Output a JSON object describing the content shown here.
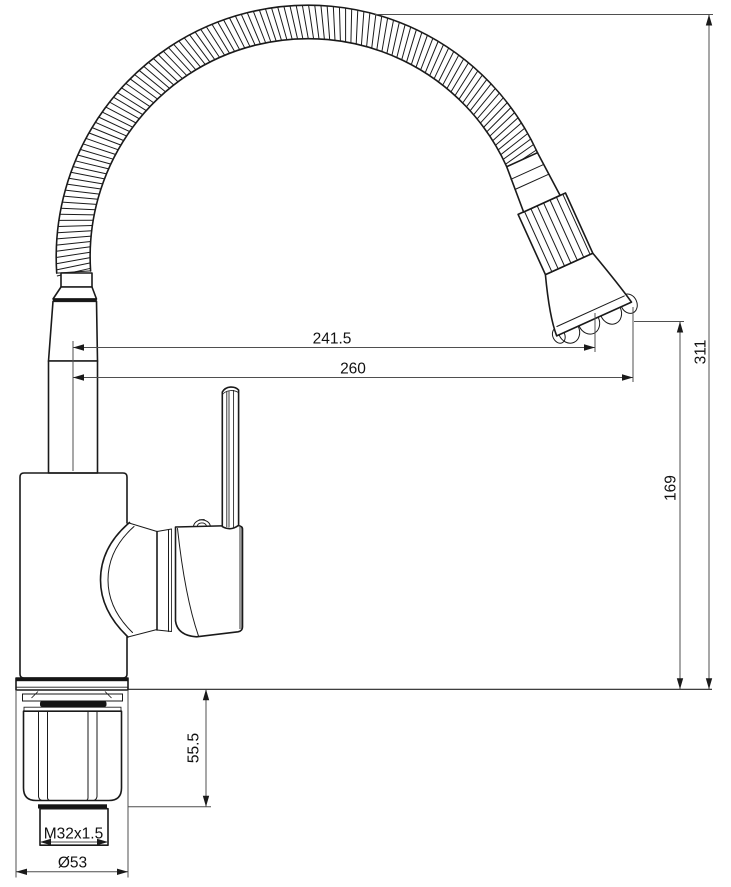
{
  "diagram": {
    "background": "#ffffff",
    "line_color": "#1a1a1a",
    "dimension_color": "#4f4f4f",
    "dimensions": {
      "reach_to_outlet": {
        "label": "241.5"
      },
      "reach_overall": {
        "label": "260"
      },
      "height_overall": {
        "label": "311"
      },
      "height_to_outlet": {
        "label": "169"
      },
      "shank_length": {
        "label": "55.5"
      },
      "thread": {
        "label": "M32x1.5"
      },
      "base_diameter": {
        "label": "Ø53"
      }
    }
  }
}
